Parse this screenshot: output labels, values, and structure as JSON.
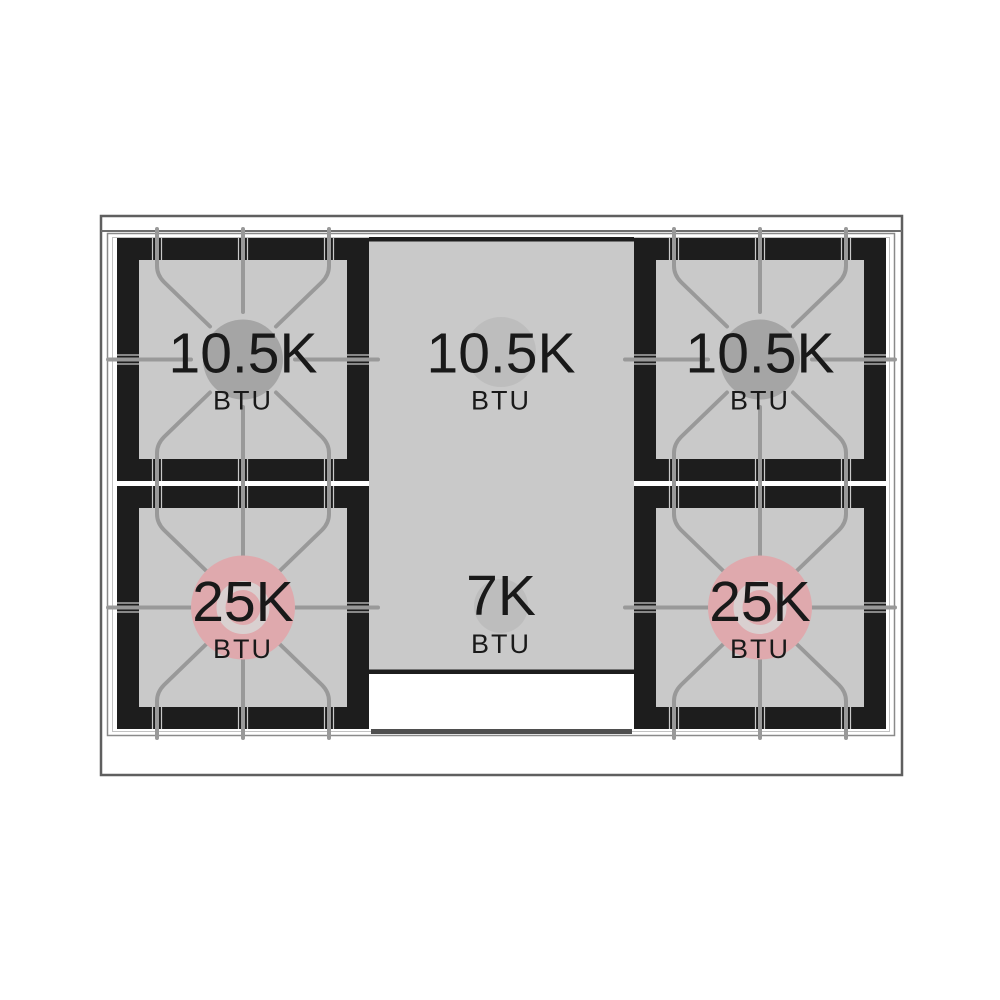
{
  "diagram": {
    "name": "gas-range-cooktop-burner-layout",
    "burners": [
      {
        "position": "rear-left",
        "value": "10.5K",
        "unit": "BTU",
        "style": "standard-sealed"
      },
      {
        "position": "rear-center",
        "value": "10.5K",
        "unit": "BTU",
        "style": "standard-sealed"
      },
      {
        "position": "rear-right",
        "value": "10.5K",
        "unit": "BTU",
        "style": "standard-sealed"
      },
      {
        "position": "front-left",
        "value": "25K",
        "unit": "BTU",
        "style": "dual-ring"
      },
      {
        "position": "front-center",
        "value": "7K",
        "unit": "BTU",
        "style": "standard-sealed"
      },
      {
        "position": "front-right",
        "value": "25K",
        "unit": "BTU",
        "style": "dual-ring"
      }
    ],
    "colors": {
      "burner_frame_black": "#1d1d1d",
      "grate_surface_gray": "#c9c9c9",
      "grate_line_gray": "#999999",
      "standard_burner_gray": "#a5a5a5",
      "panel_burner_gray": "#bdbdbd",
      "dual_ring_burner_pink": "#dfa9ad",
      "dual_ring_inner_ring": "#d9d0d0",
      "outline_gray": "#5f5f5f"
    }
  }
}
